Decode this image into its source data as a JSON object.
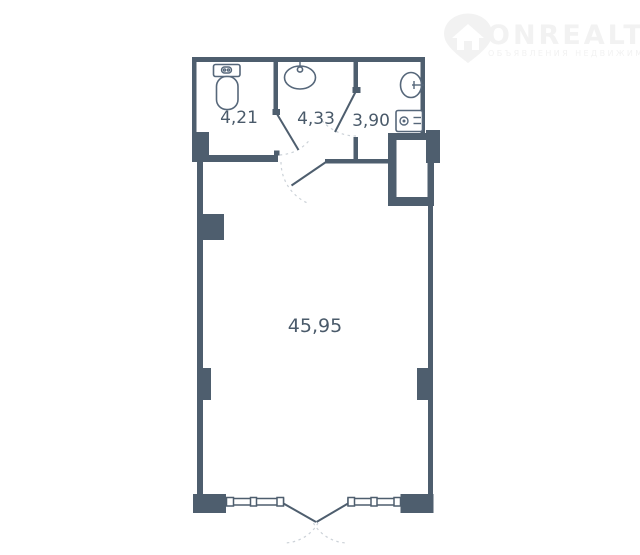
{
  "watermark": {
    "brand": "ONREALT",
    "tagline": "ОБЪЯВЛЕНИЯ НЕДВИЖИМОСТИ",
    "icon": "house-location-pin-icon"
  },
  "floorplan": {
    "kind": "apartment-floor-plan",
    "rooms": [
      {
        "id": "wc",
        "area": "4,21",
        "fixtures": [
          "toilet"
        ]
      },
      {
        "id": "bath",
        "area": "4,33",
        "fixtures": [
          "sink"
        ]
      },
      {
        "id": "laundry",
        "area": "3,90",
        "fixtures": [
          "sink",
          "washing-machine"
        ]
      },
      {
        "id": "living",
        "area": "45,95",
        "fixtures": []
      }
    ],
    "features": [
      "vent-shaft",
      "interior-doors",
      "french-balcony-doors",
      "windows",
      "wall-pillars"
    ],
    "colors": {
      "wall": "#4e5e6e",
      "fixture": "#56677a",
      "label": "#4a5a6a",
      "door_arc": "#ccd2d8",
      "background": "#ffffff",
      "watermark": "#f2f2f2"
    }
  }
}
